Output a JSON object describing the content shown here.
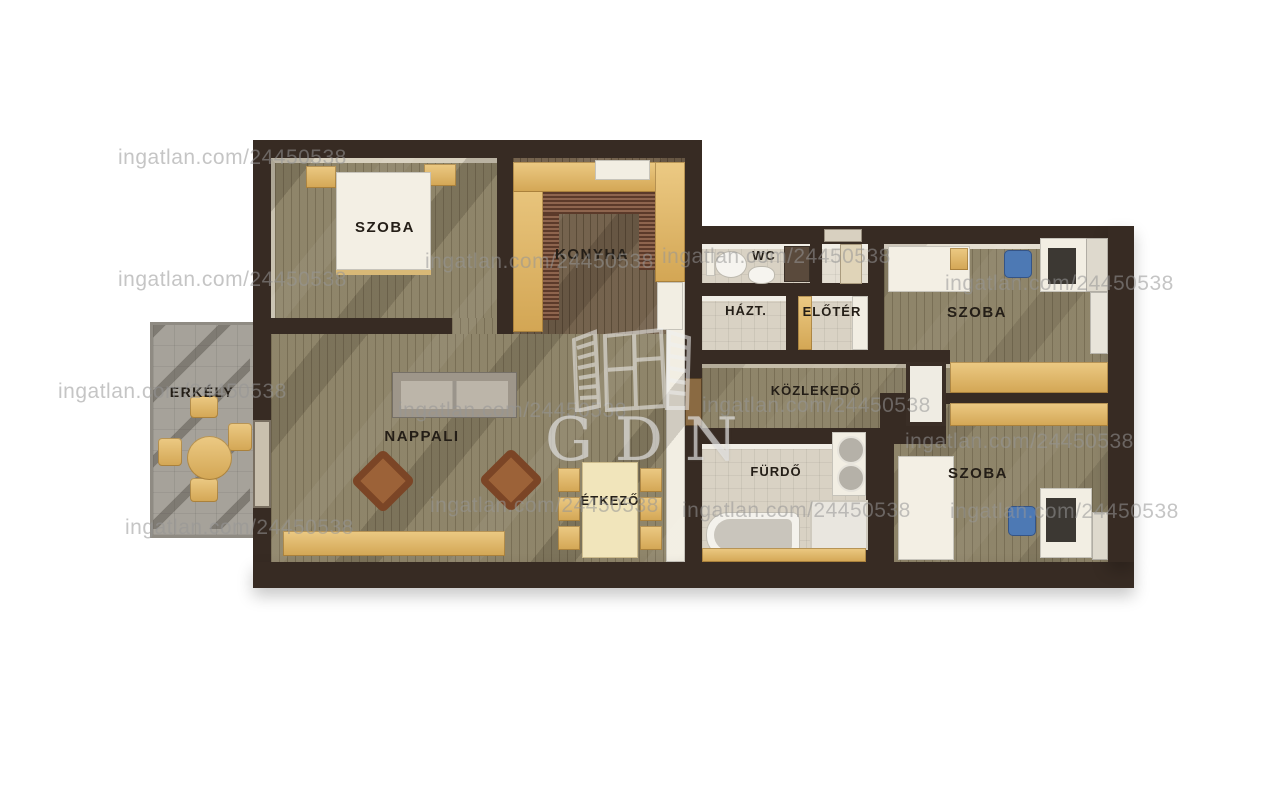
{
  "title": "apartment-floorplan",
  "watermark": {
    "text": "ingatlan.com/24450538",
    "logo_text": "GDN"
  },
  "rooms": {
    "szoba_tl": {
      "label": "SZOBA"
    },
    "konyha": {
      "label": "KONYHA"
    },
    "wc": {
      "label": "WC"
    },
    "hazt": {
      "label": "HÁZT."
    },
    "eloter": {
      "label": "ELŐTÉR"
    },
    "szoba_tr": {
      "label": "SZOBA"
    },
    "kozlekedo": {
      "label": "KÖZLEKEDŐ"
    },
    "furdo": {
      "label": "FÜRDŐ"
    },
    "szoba_br": {
      "label": "SZOBA"
    },
    "nappali": {
      "label": "NAPPALI"
    },
    "etkezo": {
      "label": "ÉTKEZŐ"
    },
    "erkely": {
      "label": "ERKÉLY"
    }
  },
  "colors": {
    "wall": "#372b23",
    "floor_wood": "#8b8165",
    "floor_wood_dark": "#6f5d47",
    "floor_tile": "#d9d2c4",
    "floor_balcony": "#a6a29a",
    "accent_gold": "#dfb768",
    "label": "#241e17",
    "watermark": "#969696"
  }
}
